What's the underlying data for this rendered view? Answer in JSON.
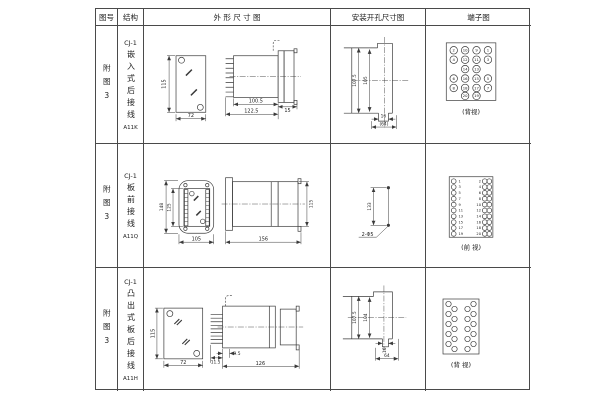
{
  "page": {
    "background": "#ffffff",
    "line_color": "#3a3a3a"
  },
  "header": {
    "figure": "图号",
    "structure": "结构",
    "outline": "外 形 尺 寸 图",
    "mounting": "安装开孔尺寸图",
    "terminal": "端子图"
  },
  "rows": [
    {
      "figure": "附图3",
      "model": "CJ-1",
      "structure": "嵌入式后接线",
      "code": "A11K",
      "view_label": "(背视)",
      "dims": {
        "front_h": "115",
        "front_w": "72",
        "side_inner": "100.5",
        "side_outer": "122.5",
        "cap": "15"
      },
      "mount": {
        "outer_v": "107.5",
        "inner_v": "105",
        "slot": "16",
        "overall": "(64)"
      },
      "terminals": [
        [
          "2",
          "10",
          "9",
          "1"
        ],
        [
          "4",
          "12",
          "11",
          "3"
        ],
        [
          "14",
          "13"
        ],
        [
          "6",
          "16",
          "15",
          "5"
        ],
        [
          "8",
          "18",
          "17",
          "7"
        ],
        [
          "20",
          "19"
        ]
      ]
    },
    {
      "figure": "附图3",
      "model": "CJ-1",
      "structure": "板前接线",
      "code": "A11Q",
      "view_label": "(前 视)",
      "dims": {
        "front_h": "148",
        "front_inner": "125",
        "front_w": "105",
        "side_len": "156",
        "side_h": "115"
      },
      "mount": {
        "span": "133",
        "holes": "2-Φ5"
      },
      "terminals_left": [
        "1",
        "3",
        "5",
        "7",
        "9",
        "11",
        "13",
        "15",
        "17",
        "19"
      ],
      "terminals_right": [
        "2",
        "4",
        "6",
        "8",
        "10",
        "12",
        "14",
        "16",
        "18",
        "20"
      ]
    },
    {
      "figure": "附图3",
      "model": "CJ-1",
      "structure": "凸出式板后接线",
      "code": "A11H",
      "view_label": "(背 视)",
      "dims": {
        "front_h": "115",
        "front_w": "72",
        "pin_depth": "11.5",
        "offset": "9.5",
        "side_len": "126"
      },
      "mount": {
        "outer_v": "107.5",
        "inner_v": "104",
        "slot": "16",
        "overall": "64"
      }
    }
  ]
}
